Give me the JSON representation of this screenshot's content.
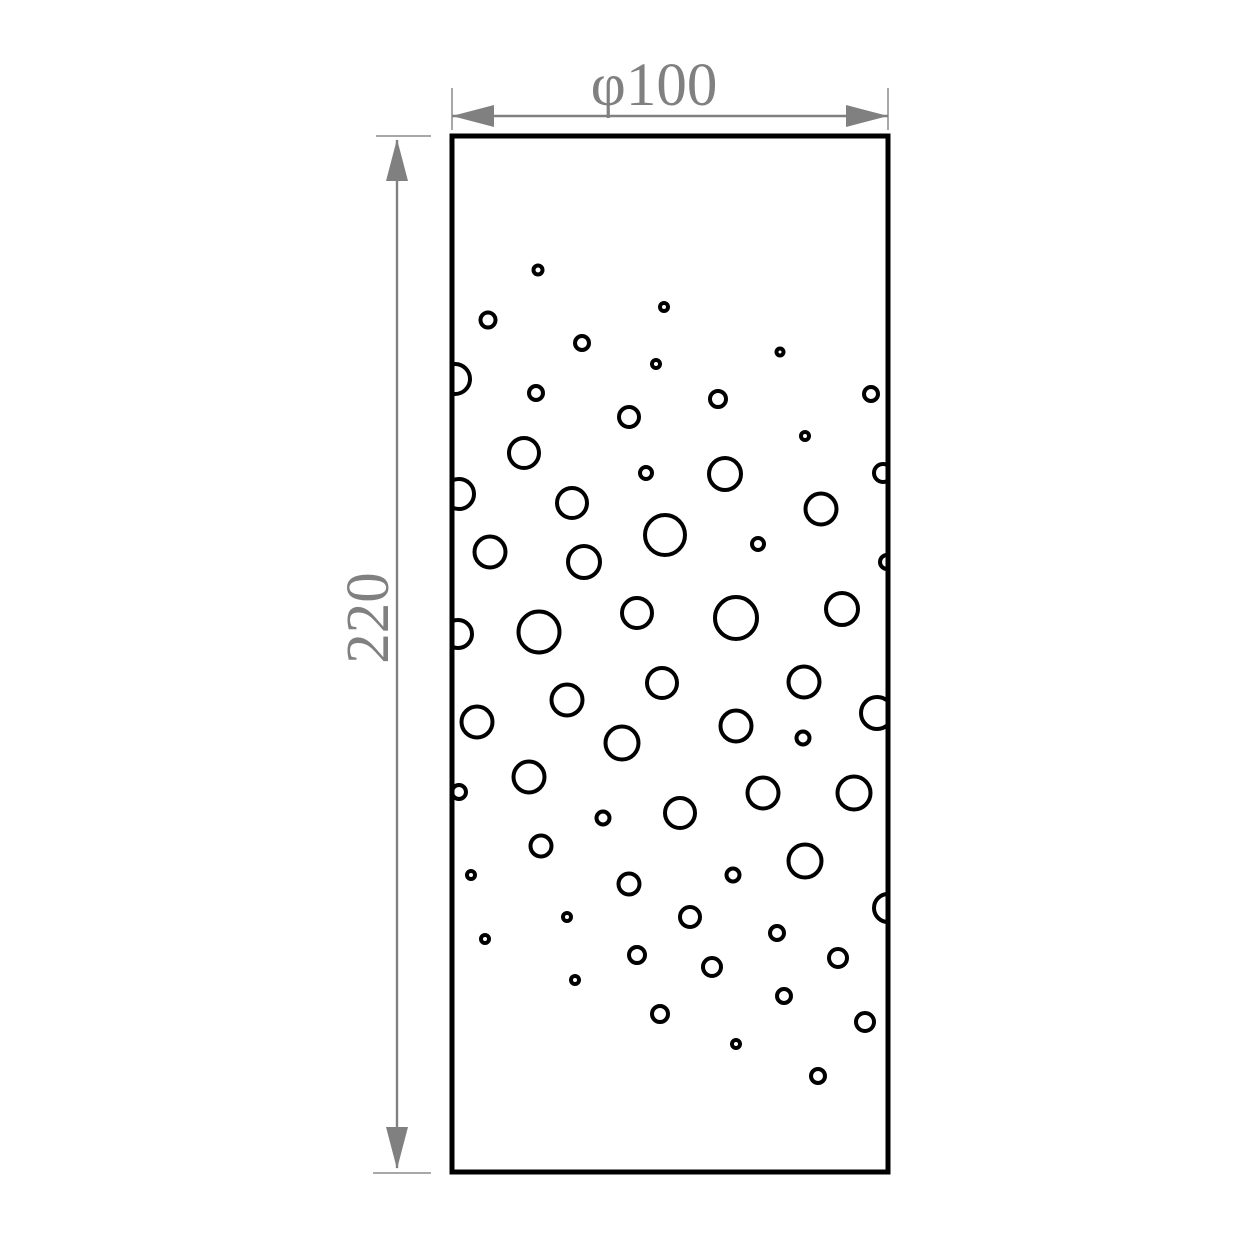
{
  "drawing": {
    "type": "dimensioned-panel-drawing",
    "width_label": "φ100",
    "height_label": "220",
    "colors": {
      "shape": "#000000",
      "dimension": "#808080",
      "extension_tick": "#a8a8a8",
      "background": "#ffffff"
    },
    "panel": {
      "x": 452,
      "y": 136,
      "width": 436,
      "height": 1036
    },
    "hole_stroke_width": 4,
    "holes": [
      [
        538,
        270,
        4.5
      ],
      [
        664,
        307,
        4
      ],
      [
        488,
        320,
        7.5
      ],
      [
        582,
        343,
        7
      ],
      [
        656,
        364,
        4
      ],
      [
        780,
        352,
        3.5
      ],
      [
        455,
        379,
        15
      ],
      [
        536,
        393,
        7
      ],
      [
        629,
        417,
        10
      ],
      [
        718,
        399,
        8
      ],
      [
        871,
        394,
        7
      ],
      [
        805,
        436,
        4
      ],
      [
        524,
        453,
        15
      ],
      [
        646,
        473,
        6
      ],
      [
        725,
        474,
        16
      ],
      [
        883,
        473,
        9
      ],
      [
        459,
        494,
        15
      ],
      [
        572,
        503,
        15
      ],
      [
        821,
        509,
        15.5
      ],
      [
        665,
        535,
        20
      ],
      [
        490,
        552,
        15.5
      ],
      [
        584,
        562,
        16
      ],
      [
        758,
        544,
        6
      ],
      [
        887,
        562,
        7
      ],
      [
        637,
        613,
        15
      ],
      [
        539,
        632,
        20.5
      ],
      [
        736,
        618,
        21
      ],
      [
        842,
        609,
        16
      ],
      [
        458,
        634,
        14
      ],
      [
        662,
        683,
        15
      ],
      [
        567,
        700,
        15.5
      ],
      [
        804,
        682,
        15.5
      ],
      [
        477,
        722,
        15.5
      ],
      [
        736,
        726,
        15.5
      ],
      [
        803,
        738,
        6.5
      ],
      [
        877,
        713,
        16
      ],
      [
        622,
        743,
        16.5
      ],
      [
        529,
        777,
        15.5
      ],
      [
        459,
        792,
        7
      ],
      [
        763,
        793,
        15.5
      ],
      [
        854,
        793,
        16.5
      ],
      [
        603,
        818,
        6.5
      ],
      [
        680,
        813,
        15
      ],
      [
        541,
        846,
        10.5
      ],
      [
        471,
        875,
        4
      ],
      [
        805,
        861,
        16.5
      ],
      [
        629,
        884,
        10.5
      ],
      [
        733,
        875,
        6.5
      ],
      [
        567,
        917,
        4
      ],
      [
        690,
        917,
        10
      ],
      [
        888,
        908,
        14
      ],
      [
        777,
        933,
        7
      ],
      [
        485,
        939,
        4
      ],
      [
        637,
        955,
        8
      ],
      [
        838,
        958,
        9
      ],
      [
        712,
        967,
        9
      ],
      [
        575,
        980,
        4
      ],
      [
        784,
        996,
        7
      ],
      [
        660,
        1014,
        8
      ],
      [
        865,
        1022,
        9
      ],
      [
        736,
        1044,
        4
      ],
      [
        818,
        1076,
        7
      ]
    ]
  }
}
